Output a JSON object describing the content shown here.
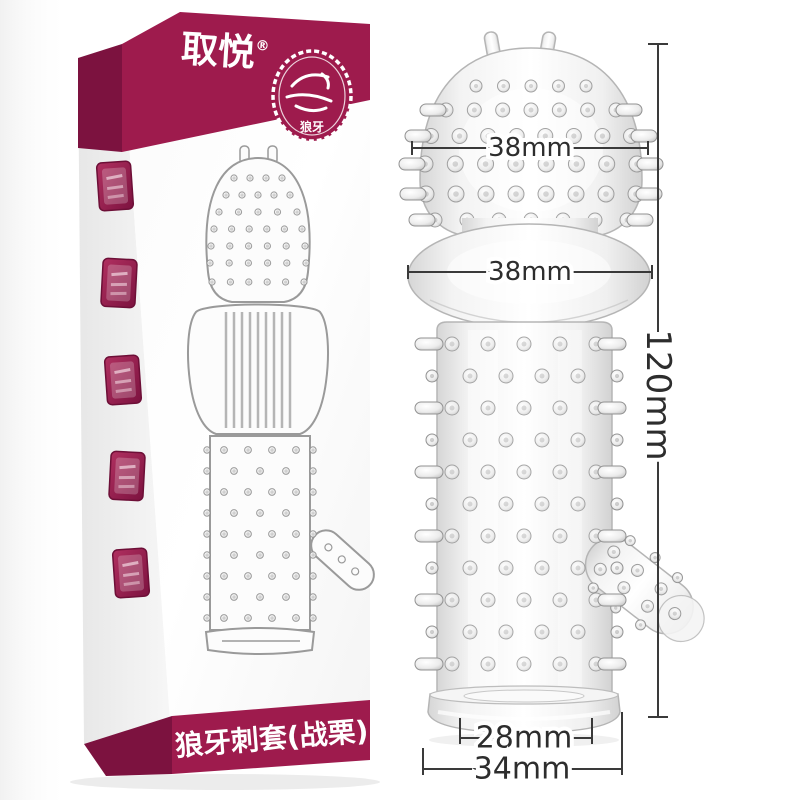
{
  "box": {
    "brand_logo": "取悦",
    "registered_mark": "®",
    "badge": {
      "icon": "wolf-stamp-icon",
      "label": "狼牙"
    },
    "bottom_label": "狼牙刺套(战栗)",
    "seal_stamps": 5
  },
  "annotations": {
    "head_width": "38mm",
    "bulb_width": "38mm",
    "total_length": "120mm",
    "opening_width": "28mm",
    "base_width": "34mm"
  },
  "colors": {
    "brand_maroon": "#9e1b4d",
    "brand_maroon_dark": "#7c123f",
    "dimension_line": "#333333",
    "product_outline": "#b5b5b5",
    "background": "#ffffff"
  }
}
